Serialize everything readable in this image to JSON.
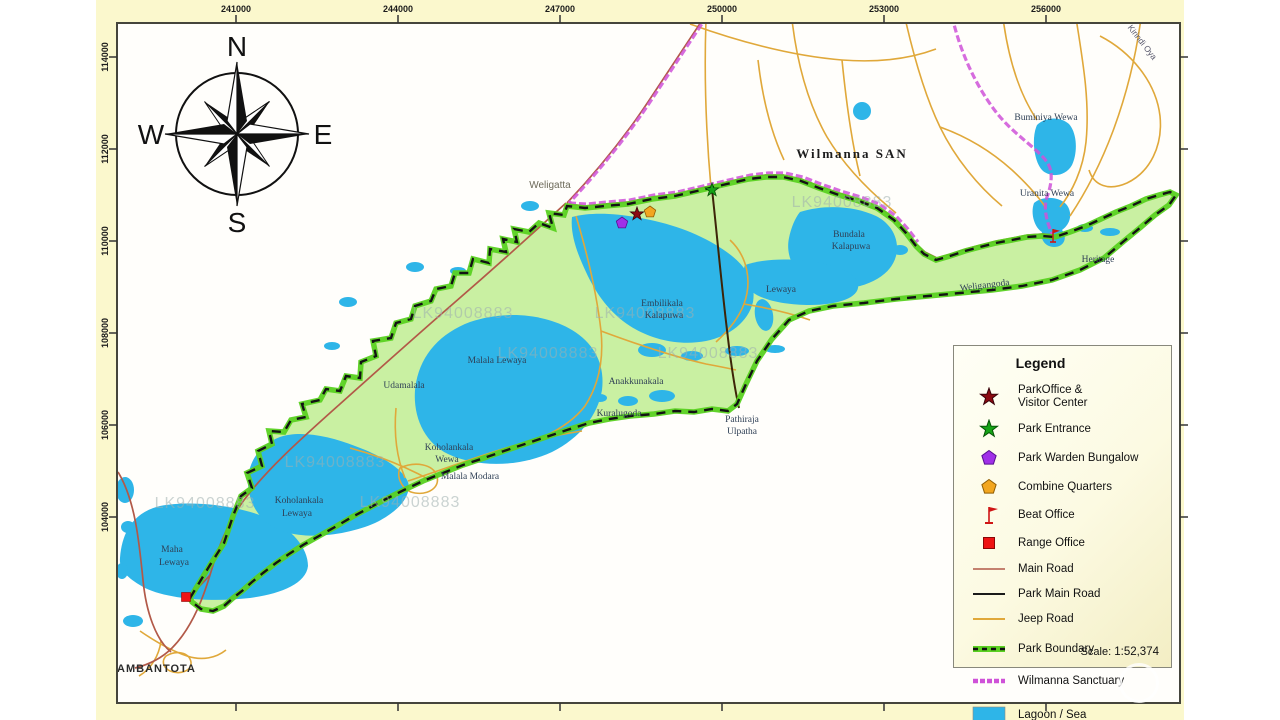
{
  "colors": {
    "page_bg": "#fbf8cd",
    "map_bg": "#fffefb",
    "park_green": "#c9f0a2",
    "boundary_green": "#5ad121",
    "boundary_dash": "#131313",
    "lagoon": "#2eb5e8",
    "main_road": "#b25948",
    "park_main_road": "#3d2408",
    "jeep_road": "#e0a83a",
    "sanctuary": "#cf52d8",
    "star_red": "#8b0a12",
    "star_green": "#16a316",
    "pentagon_purple": "#a02fe8",
    "pentagon_orange": "#f2a61f",
    "office_red": "#ee1313"
  },
  "axes": {
    "top": [
      "241000",
      "244000",
      "247000",
      "250000",
      "253000",
      "256000"
    ],
    "left": [
      "114000",
      "112000",
      "110000",
      "108000",
      "106000",
      "104000"
    ]
  },
  "compass": {
    "n": "N",
    "e": "E",
    "s": "S",
    "w": "W"
  },
  "map": {
    "labels": [
      {
        "t": "Weligatta",
        "x": 550,
        "y": 188,
        "cls": "town"
      },
      {
        "t": "Wilmanna SAN",
        "x": 852,
        "y": 158,
        "cls": "region"
      },
      {
        "t": "Buminiya Wewa",
        "x": 1046,
        "y": 120,
        "cls": "place"
      },
      {
        "t": "Uranita Wewa",
        "x": 1047,
        "y": 196,
        "cls": "place"
      },
      {
        "t": "Heritage",
        "x": 1098,
        "y": 262,
        "cls": "place"
      },
      {
        "t": "Bundala",
        "x": 849,
        "y": 237,
        "cls": "place"
      },
      {
        "t": "Kalapuwa",
        "x": 851,
        "y": 249,
        "cls": "place"
      },
      {
        "t": "Lewaya",
        "x": 781,
        "y": 292,
        "cls": "place"
      },
      {
        "t": "Weligangoda",
        "x": 985,
        "y": 288,
        "cls": "place",
        "rot": -7
      },
      {
        "t": "Embilikala",
        "x": 662,
        "y": 306,
        "cls": "place"
      },
      {
        "t": "Kalapuwa",
        "x": 664,
        "y": 318,
        "cls": "place"
      },
      {
        "t": "Malala Lewaya",
        "x": 497,
        "y": 363,
        "cls": "place"
      },
      {
        "t": "Anakkunakala",
        "x": 636,
        "y": 384,
        "cls": "place"
      },
      {
        "t": "Kuralugoda",
        "x": 619,
        "y": 416,
        "cls": "place"
      },
      {
        "t": "Udamalala",
        "x": 404,
        "y": 388,
        "cls": "place"
      },
      {
        "t": "Koholankala",
        "x": 449,
        "y": 450,
        "cls": "place"
      },
      {
        "t": "Wewa",
        "x": 447,
        "y": 462,
        "cls": "place"
      },
      {
        "t": "Malala Modara",
        "x": 470,
        "y": 479,
        "cls": "place"
      },
      {
        "t": "Koholankala",
        "x": 299,
        "y": 503,
        "cls": "place"
      },
      {
        "t": "Lewaya",
        "x": 297,
        "y": 516,
        "cls": "place"
      },
      {
        "t": "Maha",
        "x": 172,
        "y": 552,
        "cls": "place"
      },
      {
        "t": "Lewaya",
        "x": 174,
        "y": 565,
        "cls": "place"
      },
      {
        "t": "Pathiraja",
        "x": 742,
        "y": 422,
        "cls": "place"
      },
      {
        "t": "Ulpatha",
        "x": 742,
        "y": 434,
        "cls": "place"
      },
      {
        "t": "HAMBANTOTA",
        "x": 152,
        "y": 672,
        "cls": "city"
      },
      {
        "t": "Kirindi Oya",
        "x": 1140,
        "y": 44,
        "cls": "river",
        "rot": 52
      }
    ],
    "markers": [
      {
        "name": "park-office-visitor-center-marker",
        "symbol": "park-office",
        "x": 637,
        "y": 214
      },
      {
        "name": "combine-quarters-marker",
        "symbol": "quarters",
        "x": 650,
        "y": 212
      },
      {
        "name": "park-warden-bungalow-marker",
        "symbol": "warden",
        "x": 622,
        "y": 223
      },
      {
        "name": "park-entrance-marker",
        "symbol": "park-entrance",
        "x": 712,
        "y": 190
      },
      {
        "name": "beat-office-marker",
        "symbol": "beat",
        "x": 1053,
        "y": 236
      },
      {
        "name": "range-office-marker",
        "symbol": "range",
        "x": 186,
        "y": 597
      }
    ],
    "watermark": {
      "text": "LK94008883",
      "positions": [
        [
          842,
          207
        ],
        [
          463,
          318
        ],
        [
          645,
          318
        ],
        [
          548,
          358
        ],
        [
          708,
          358
        ],
        [
          335,
          467
        ],
        [
          205,
          508
        ],
        [
          410,
          507
        ]
      ]
    }
  },
  "legend": {
    "title": "Legend",
    "items": [
      {
        "icon": "star-red",
        "label": "ParkOffice &",
        "label2": "Visitor Center"
      },
      {
        "icon": "star-green",
        "label": "Park Entrance"
      },
      {
        "icon": "pentagon-purple",
        "label": "Park Warden Bungalow"
      },
      {
        "icon": "pentagon-orange",
        "label": "Combine Quarters"
      },
      {
        "icon": "flag-red",
        "label": "Beat Office"
      },
      {
        "icon": "square-red",
        "label": "Range Office"
      },
      {
        "icon": "line-main-road",
        "label": "Main Road"
      },
      {
        "icon": "line-park-main-road",
        "label": "Park Main Road"
      },
      {
        "icon": "line-jeep-road",
        "label": "Jeep Road"
      },
      {
        "icon": "line-park-boundary",
        "label": "Park Boundary"
      },
      {
        "icon": "line-wilmanna",
        "label": "Wilmanna Sanctuary"
      },
      {
        "icon": "swatch-lagoon",
        "label": "Lagoon / Sea"
      }
    ],
    "scale_label": "Scale:",
    "scale_value": "1:52,374"
  }
}
